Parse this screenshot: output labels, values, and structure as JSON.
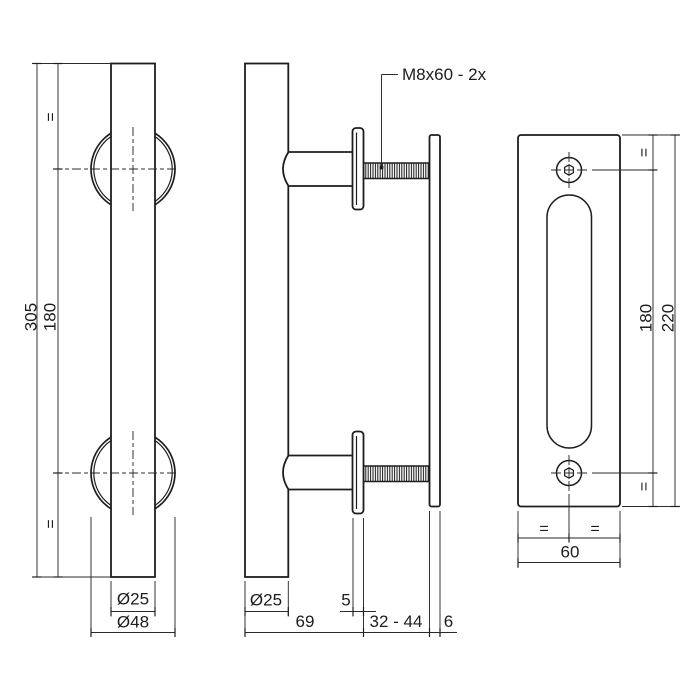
{
  "drawing": {
    "type": "technical-dimension-drawing",
    "subject": "door pull handle with back plate",
    "colors": {
      "line": "#1d1d1d",
      "thin_line": "#2b2b2b",
      "background": "#ffffff"
    },
    "front_view": {
      "length": "305",
      "hole_spacing": "180",
      "eq_top": "=",
      "eq_bottom": "=",
      "bar_diameter": "Ø25",
      "rose_diameter": "Ø48"
    },
    "side_view": {
      "bolt_label": "M8x60 - 2x",
      "bar_diameter": "Ø25",
      "rose_thickness": "5",
      "projection": "69",
      "bolt_range": "32 - 44",
      "plate_thickness": "6"
    },
    "plate_view": {
      "hole_spacing": "180",
      "height": "220",
      "width": "60",
      "eq_top": "=",
      "eq_bottom": "=",
      "eq_left": "=",
      "eq_right": "="
    }
  }
}
